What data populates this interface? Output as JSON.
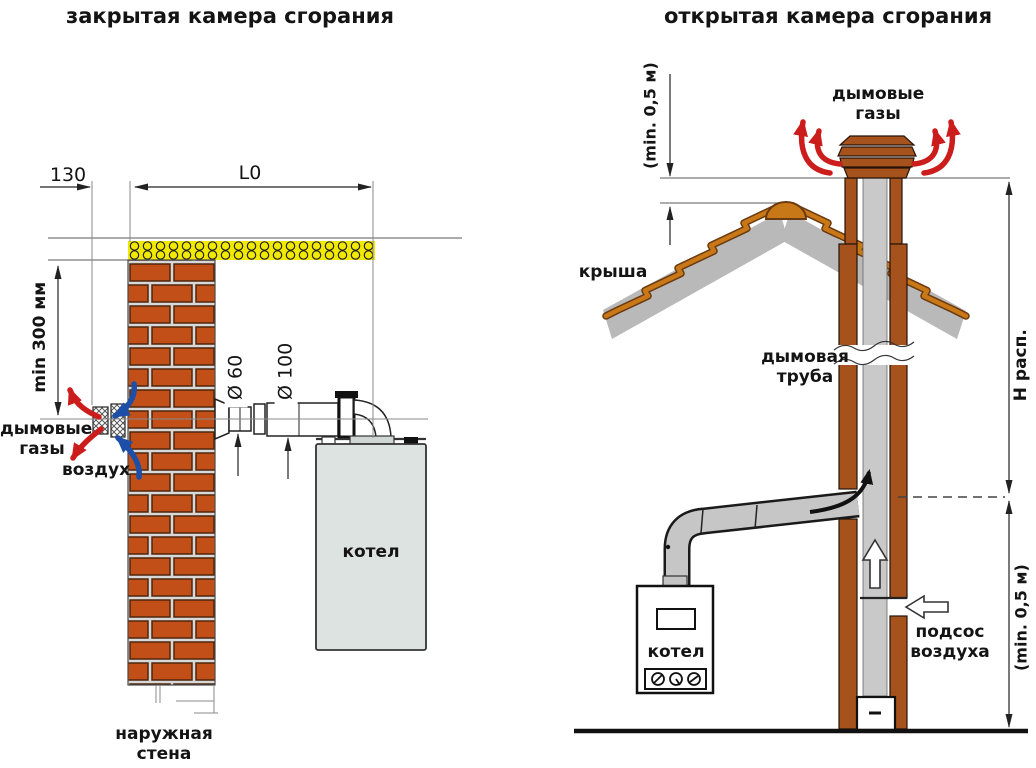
{
  "left_diagram": {
    "title": "закрытая камера сгорания",
    "dim_130": "130",
    "dim_l0": "L0",
    "dim_min300": "min 300 мм",
    "dim_d60": "Ø 60",
    "dim_d100": "Ø 100",
    "label_flue_gases": "дымовые газы",
    "label_air": "воздух",
    "label_boiler": "котел",
    "label_outer_wall": "наружная стена"
  },
  "right_diagram": {
    "title": "открытая камера сгорания",
    "dim_min05_roof": "(min. 0,5 м)",
    "dim_h_available": "Н расп.",
    "dim_min05_bottom": "(min. 0,5 м)",
    "label_flue_gases": "дымовые газы",
    "label_roof": "крыша",
    "label_chimney": "дымовая труба",
    "label_boiler": "котел",
    "label_air_suction": "подсос воздуха"
  },
  "colors": {
    "brick": "#c24f17",
    "mortar": "#d8d8d8",
    "insulation": "#f2e900",
    "chimney": "#a5521c",
    "roof": "#b9b9b9",
    "roof_trim": "#c97818",
    "flue_red": "#cc1d1d",
    "air_blue": "#1d4fa8",
    "boiler_gray": "#dde3e0",
    "pipe_gray": "#c6c6c6"
  }
}
